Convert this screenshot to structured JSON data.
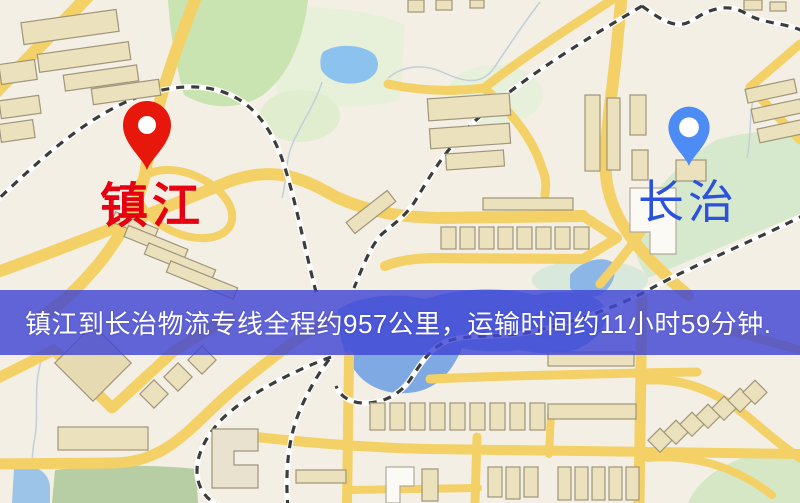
{
  "banner": {
    "text": "镇江到长治物流专线全程约957公里，运输时间约11小时59分钟.",
    "background_color": "#4046d4",
    "text_color": "#ffffff"
  },
  "route": {
    "distance_text": "957公里",
    "duration_text": "11小时59分钟"
  },
  "markers": {
    "origin": {
      "label": "镇江",
      "pin_color": "#e8170b",
      "label_color": "#e60012"
    },
    "destination": {
      "label": "长治",
      "pin_color": "#4d8cf5",
      "label_color": "#2b52dd"
    }
  },
  "map_palette": {
    "base": "#f3efe4",
    "road": "#f4d166",
    "building_fill": "#ece1bd",
    "building_stroke": "#a0957a",
    "park": "#c9e4b0",
    "water": "#7ea9e2",
    "pond": "#8cc2ee",
    "railway": "#3c3c3c"
  }
}
